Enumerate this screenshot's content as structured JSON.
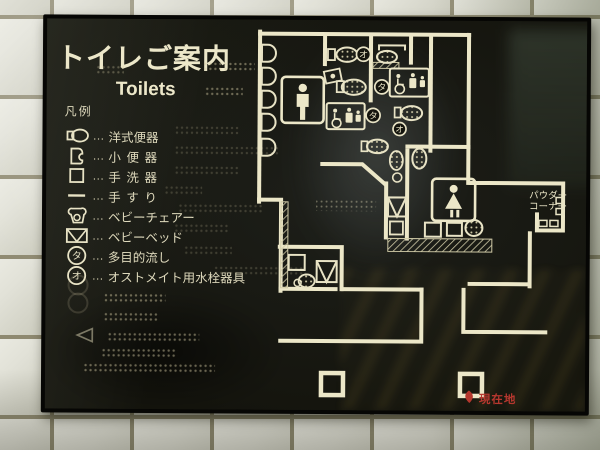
{
  "sign": {
    "title": "トイレご案内",
    "subtitle_en": "Toilets",
    "panel_color": "#14140d",
    "line_color": "#ece7c8",
    "marker_red": "#b5372e"
  },
  "legend": {
    "header": "凡例",
    "separator": "…",
    "items": [
      {
        "label": "洋式便器",
        "icon": "western-toilet-icon"
      },
      {
        "label": "小便器",
        "icon": "urinal-icon"
      },
      {
        "label": "手洗器",
        "icon": "wash-basin-icon"
      },
      {
        "label": "手すり",
        "icon": "handrail-icon"
      },
      {
        "label": "ベビーチェアー",
        "icon": "baby-chair-icon"
      },
      {
        "label": "ベビーベッド",
        "icon": "baby-bed-icon"
      },
      {
        "label": "多目的流し",
        "icon": "multipurpose-sink-symbol",
        "symbol": "タ"
      },
      {
        "label": "オストメイト用水栓器具",
        "icon": "ostomate-fixture-symbol",
        "symbol": "オ"
      }
    ]
  },
  "map": {
    "labels": {
      "powder_corner_line1": "パウダー",
      "powder_corner_line2": "コーナー",
      "you_are_here": "現在地"
    },
    "symbols": {
      "multipurpose": "タ",
      "ostomate": "オ"
    }
  }
}
